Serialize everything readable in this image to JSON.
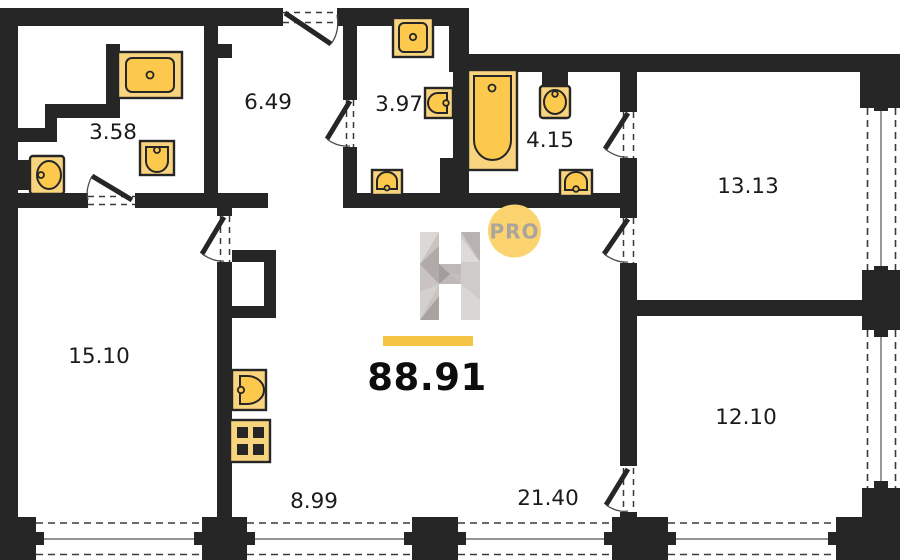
{
  "plan": {
    "total_area": "88.91",
    "rooms": {
      "wc": "3.58",
      "hall": "6.49",
      "laundry": "3.97",
      "bathroom": "4.15",
      "bedroom_top_right": "13.13",
      "bedroom_left": "15.10",
      "bedroom_bottom_right": "12.10",
      "kitchen_zone": "8.99",
      "living_zone": "21.40"
    },
    "logo": {
      "letter": "H",
      "badge": "PRO"
    },
    "colors": {
      "wall": "#262626",
      "fixture_fill": "#fcc94d",
      "fixture_light": "#f9d47f",
      "accent_bar": "#f6c444",
      "badge_fill": "#fbd470"
    }
  }
}
